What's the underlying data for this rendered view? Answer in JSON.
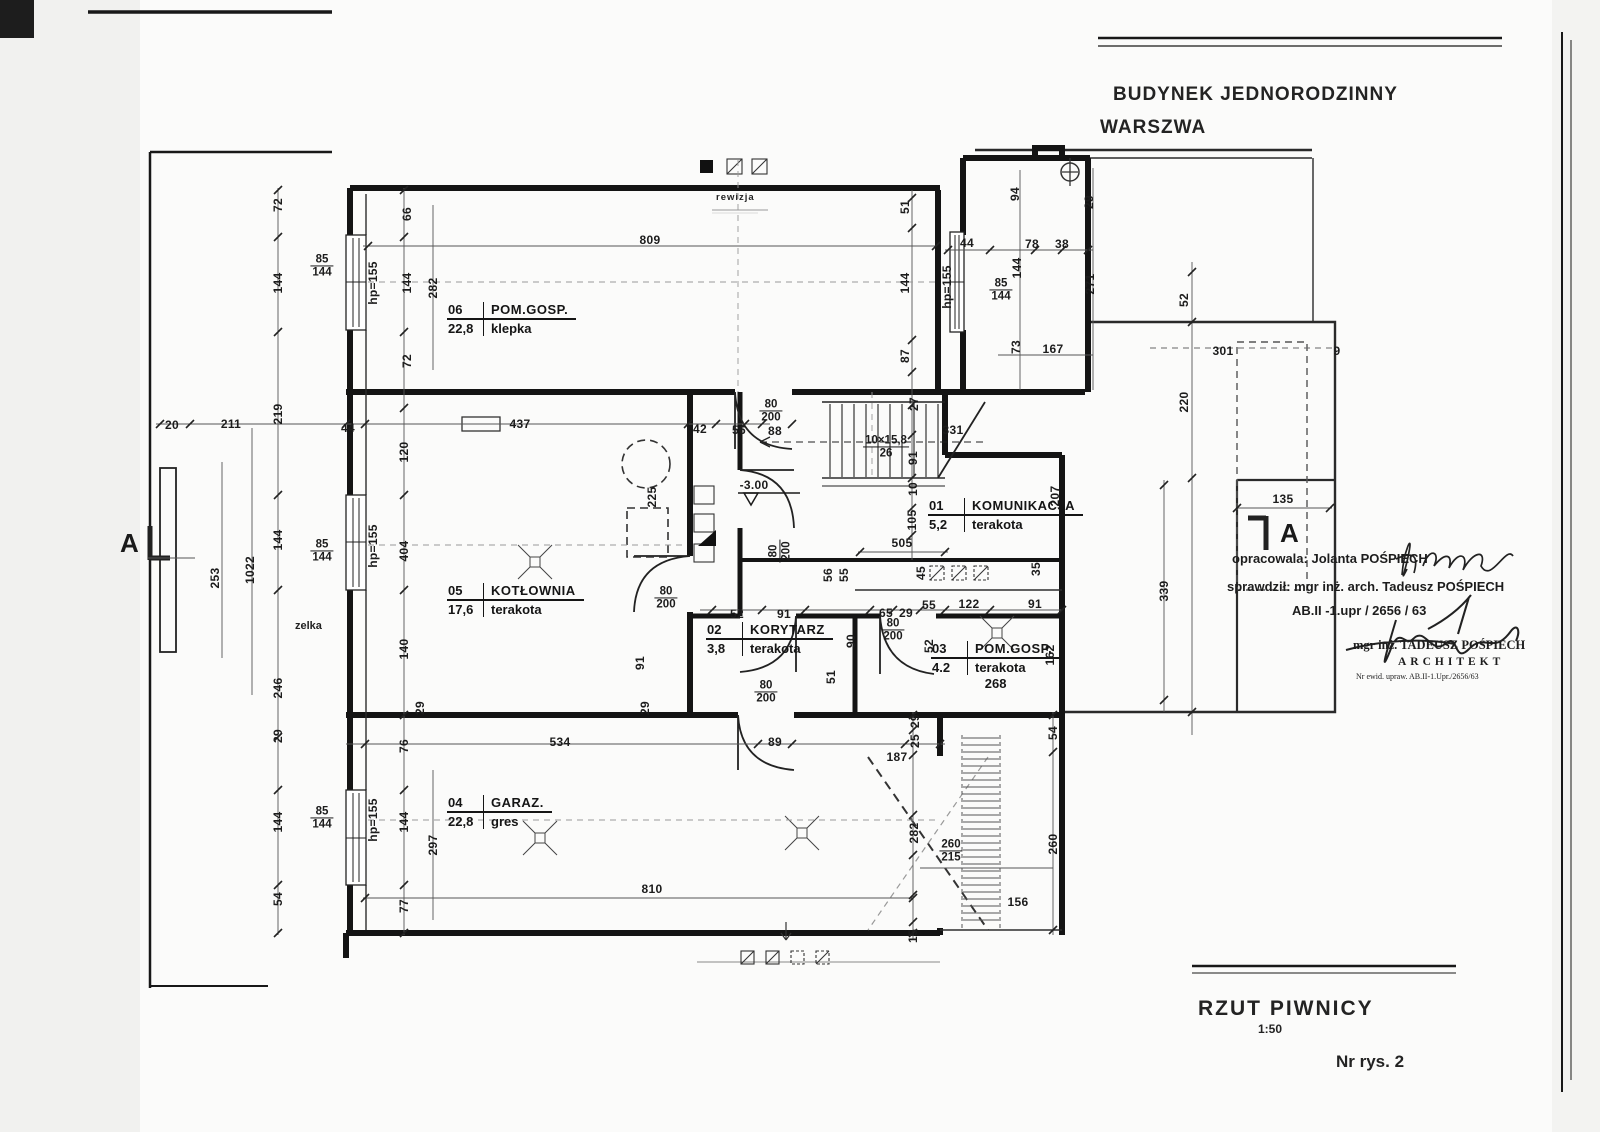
{
  "header": {
    "line1": "BUDYNEK JEDNORODZINNY",
    "line2": "WARSZWA"
  },
  "footer": {
    "title": "RZUT PIWNICY",
    "scale": "1:50",
    "sheet": "Nr rys. 2"
  },
  "notes": {
    "prepared": "opracowala: Jolanta POŚPIECH",
    "checked": "sprawdził: mgr inż. arch. Tadeusz POŚPIECH",
    "license": "AB.II -1.upr / 2656 / 63",
    "stamp_name": "mgr inż. TADEUSZ POŚPIECH",
    "stamp_title": "ARCHITEKT",
    "stamp_reg": "Nr ewid. upraw. AB.II-1.Upr./2656/63"
  },
  "section_markers": {
    "left": "A",
    "right": "A"
  },
  "annotations": {
    "revision": "rewizja",
    "zelka": "zelka"
  },
  "rooms": [
    {
      "no": "06",
      "name": "POM.GOSP.",
      "area": "22,8",
      "floor": "klepka",
      "x": 447,
      "y": 302,
      "extra": ""
    },
    {
      "no": "05",
      "name": "KOTŁOWNIA",
      "area": "17,6",
      "floor": "terakota",
      "x": 447,
      "y": 583,
      "extra": ""
    },
    {
      "no": "02",
      "name": "KORYTARZ",
      "area": "3,8",
      "floor": "terakota",
      "x": 706,
      "y": 622,
      "extra": ""
    },
    {
      "no": "01",
      "name": "KOMUNIKACJA",
      "area": "5,2",
      "floor": "terakota",
      "x": 928,
      "y": 498,
      "extra": ""
    },
    {
      "no": "03",
      "name": "POM.GOSP.",
      "area": "4.2",
      "floor": "terakota",
      "x": 931,
      "y": 641,
      "extra": "268"
    },
    {
      "no": "04",
      "name": "GARAZ.",
      "area": "22,8",
      "floor": "gres",
      "x": 447,
      "y": 795,
      "extra": ""
    }
  ],
  "dims": [
    {
      "t": "72",
      "x": 278,
      "y": 205,
      "r": 1
    },
    {
      "t": "144",
      "x": 278,
      "y": 283,
      "r": 1
    },
    {
      "t": "219",
      "x": 278,
      "y": 414,
      "r": 1
    },
    {
      "t": "144",
      "x": 278,
      "y": 540,
      "r": 1
    },
    {
      "t": "246",
      "x": 278,
      "y": 688,
      "r": 1
    },
    {
      "t": "29",
      "x": 278,
      "y": 736,
      "r": 1
    },
    {
      "t": "144",
      "x": 278,
      "y": 822,
      "r": 1
    },
    {
      "t": "54",
      "x": 278,
      "y": 899,
      "r": 1
    },
    {
      "t": "66",
      "x": 407,
      "y": 214,
      "r": 1
    },
    {
      "t": "144",
      "x": 407,
      "y": 283,
      "r": 1
    },
    {
      "t": "72",
      "x": 407,
      "y": 361,
      "r": 1
    },
    {
      "t": "282",
      "x": 433,
      "y": 288,
      "r": 1
    },
    {
      "t": "120",
      "x": 404,
      "y": 452,
      "r": 1
    },
    {
      "t": "404",
      "x": 404,
      "y": 551,
      "r": 1
    },
    {
      "t": "140",
      "x": 404,
      "y": 649,
      "r": 1
    },
    {
      "t": "76",
      "x": 404,
      "y": 746,
      "r": 1
    },
    {
      "t": "144",
      "x": 404,
      "y": 822,
      "r": 1
    },
    {
      "t": "297",
      "x": 433,
      "y": 845,
      "r": 1
    },
    {
      "t": "77",
      "x": 404,
      "y": 906,
      "r": 1
    },
    {
      "t": "hp=155",
      "x": 373,
      "y": 283,
      "r": 1
    },
    {
      "t": "hp=155",
      "x": 373,
      "y": 546,
      "r": 1
    },
    {
      "t": "hp=155",
      "x": 373,
      "y": 820,
      "r": 1
    },
    {
      "t": "hp=155",
      "x": 947,
      "y": 287,
      "r": 1
    },
    {
      "t": "20",
      "x": 172,
      "y": 425
    },
    {
      "t": "211",
      "x": 231,
      "y": 424
    },
    {
      "t": "44",
      "x": 348,
      "y": 428
    },
    {
      "t": "437",
      "x": 520,
      "y": 424
    },
    {
      "t": "42",
      "x": 700,
      "y": 429
    },
    {
      "t": "56",
      "x": 739,
      "y": 430
    },
    {
      "t": "88",
      "x": 775,
      "y": 431
    },
    {
      "t": "809",
      "x": 650,
      "y": 240
    },
    {
      "t": "51",
      "x": 905,
      "y": 207,
      "r": 1
    },
    {
      "t": "144",
      "x": 905,
      "y": 283,
      "r": 1
    },
    {
      "t": "87",
      "x": 905,
      "y": 356,
      "r": 1
    },
    {
      "t": "27",
      "x": 914,
      "y": 404,
      "r": 1
    },
    {
      "t": "44",
      "x": 967,
      "y": 243
    },
    {
      "t": "78",
      "x": 1032,
      "y": 244
    },
    {
      "t": "38",
      "x": 1062,
      "y": 244
    },
    {
      "t": "94",
      "x": 1015,
      "y": 194,
      "r": 1
    },
    {
      "t": "29",
      "x": 1089,
      "y": 202,
      "r": 1
    },
    {
      "t": "144",
      "x": 1017,
      "y": 268,
      "r": 1
    },
    {
      "t": "271",
      "x": 1090,
      "y": 284,
      "r": 1
    },
    {
      "t": "73",
      "x": 1016,
      "y": 347,
      "r": 1
    },
    {
      "t": "167",
      "x": 1053,
      "y": 349
    },
    {
      "t": "52",
      "x": 1184,
      "y": 300,
      "r": 1
    },
    {
      "t": "301",
      "x": 1223,
      "y": 351
    },
    {
      "t": "220",
      "x": 1184,
      "y": 402,
      "r": 1
    },
    {
      "t": "9",
      "x": 1337,
      "y": 351
    },
    {
      "t": "135",
      "x": 1283,
      "y": 499
    },
    {
      "t": "339",
      "x": 1164,
      "y": 591,
      "r": 1
    },
    {
      "t": "331",
      "x": 953,
      "y": 430
    },
    {
      "t": "91",
      "x": 913,
      "y": 458,
      "r": 1
    },
    {
      "t": "10",
      "x": 913,
      "y": 489,
      "r": 1
    },
    {
      "t": "105",
      "x": 912,
      "y": 520,
      "r": 1
    },
    {
      "t": "505",
      "x": 902,
      "y": 543
    },
    {
      "t": "207",
      "x": 1055,
      "y": 496,
      "r": 1
    },
    {
      "t": "-3.00",
      "x": 754,
      "y": 485
    },
    {
      "t": "52",
      "x": 737,
      "y": 614
    },
    {
      "t": "91",
      "x": 784,
      "y": 614
    },
    {
      "t": "65",
      "x": 886,
      "y": 613
    },
    {
      "t": "29",
      "x": 906,
      "y": 613
    },
    {
      "t": "55",
      "x": 929,
      "y": 605
    },
    {
      "t": "122",
      "x": 969,
      "y": 604
    },
    {
      "t": "91",
      "x": 1035,
      "y": 604
    },
    {
      "t": "90",
      "x": 851,
      "y": 641,
      "r": 1
    },
    {
      "t": "56",
      "x": 828,
      "y": 575,
      "r": 1
    },
    {
      "t": "55",
      "x": 844,
      "y": 575,
      "r": 1
    },
    {
      "t": "45",
      "x": 921,
      "y": 573,
      "r": 1
    },
    {
      "t": "35",
      "x": 1036,
      "y": 569,
      "r": 1
    },
    {
      "t": "91",
      "x": 640,
      "y": 663,
      "r": 1
    },
    {
      "t": "29",
      "x": 420,
      "y": 708,
      "r": 1
    },
    {
      "t": "29",
      "x": 645,
      "y": 708,
      "r": 1
    },
    {
      "t": "51",
      "x": 831,
      "y": 677,
      "r": 1
    },
    {
      "t": "52",
      "x": 929,
      "y": 646,
      "r": 1
    },
    {
      "t": "162",
      "x": 1050,
      "y": 655,
      "r": 1
    },
    {
      "t": "225",
      "x": 652,
      "y": 497,
      "r": 1
    },
    {
      "t": "268? ",
      "x": -100,
      "y": -100
    },
    {
      "t": "534",
      "x": 560,
      "y": 742
    },
    {
      "t": "89",
      "x": 775,
      "y": 742
    },
    {
      "t": "187",
      "x": 897,
      "y": 757
    },
    {
      "t": "29",
      "x": 915,
      "y": 721,
      "r": 1
    },
    {
      "t": "25",
      "x": 915,
      "y": 741,
      "r": 1
    },
    {
      "t": "54",
      "x": 1053,
      "y": 733,
      "r": 1
    },
    {
      "t": "282",
      "x": 914,
      "y": 833,
      "r": 1
    },
    {
      "t": "260",
      "x": 1053,
      "y": 844,
      "r": 1
    },
    {
      "t": "156",
      "x": 1018,
      "y": 902
    },
    {
      "t": "810",
      "x": 652,
      "y": 889
    },
    {
      "t": "15",
      "x": 913,
      "y": 936,
      "r": 1
    },
    {
      "t": "253",
      "x": 215,
      "y": 578,
      "r": 1
    },
    {
      "t": "1022",
      "x": 250,
      "y": 570,
      "r": 1
    }
  ],
  "fracs": [
    {
      "a": "85",
      "b": "144",
      "x": 322,
      "y": 266
    },
    {
      "a": "85",
      "b": "144",
      "x": 322,
      "y": 551
    },
    {
      "a": "85",
      "b": "144",
      "x": 322,
      "y": 818
    },
    {
      "a": "85",
      "b": "144",
      "x": 1001,
      "y": 290
    },
    {
      "a": "80",
      "b": "200",
      "x": 771,
      "y": 411
    },
    {
      "a": "80",
      "b": "200",
      "x": 666,
      "y": 598
    },
    {
      "a": "80",
      "b": "200",
      "x": 780,
      "y": 551,
      "r": 1
    },
    {
      "a": "80",
      "b": "200",
      "x": 893,
      "y": 630
    },
    {
      "a": "80",
      "b": "200",
      "x": 766,
      "y": 692
    },
    {
      "a": "10×15,8",
      "b": "26",
      "x": 886,
      "y": 447
    },
    {
      "a": "260",
      "b": "215",
      "x": 951,
      "y": 851
    }
  ],
  "colors": {
    "ink": "#1a1a1a",
    "paper": "#fbfbfa",
    "faint": "#8a8a88"
  }
}
